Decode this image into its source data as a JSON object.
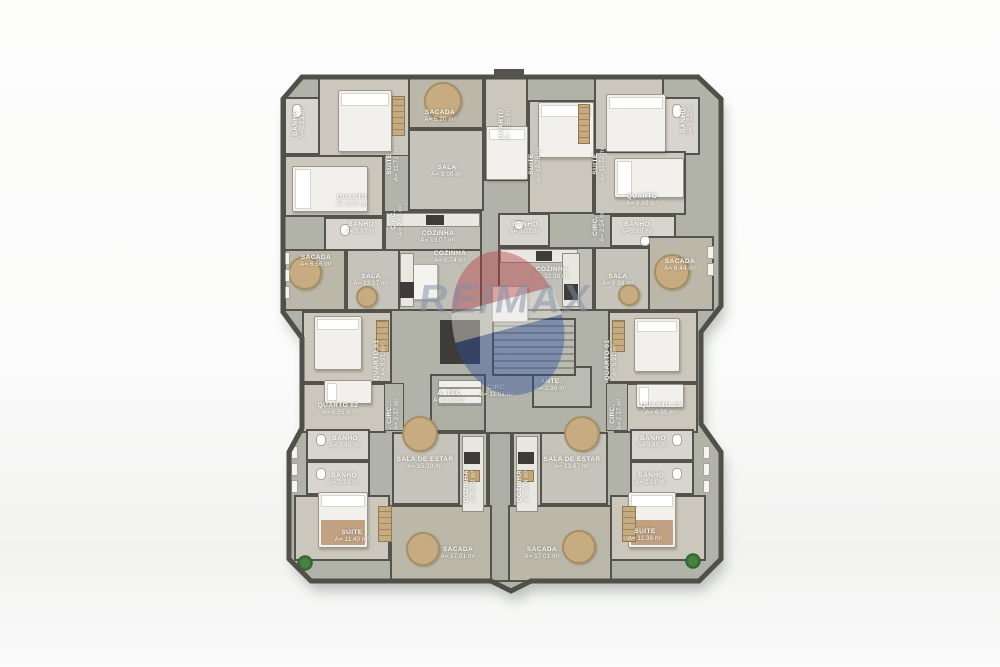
{
  "watermark": {
    "brand": "RE/MAX"
  },
  "rooms": [
    {
      "name": "BANHO",
      "area": "A= 3.23 m²"
    },
    {
      "name": "SUITE",
      "area": "A= 11.72 m²"
    },
    {
      "name": "QUARTO",
      "area": "A= 9.90 m²"
    },
    {
      "name": "BANHO",
      "area": "A= 2.87 m²"
    },
    {
      "name": "SACADA",
      "area": "A= 5.20 m²"
    },
    {
      "name": "SALA",
      "area": "A= 8.00 m²"
    },
    {
      "name": "CIRC.",
      "area": "A= 2.54 m²"
    },
    {
      "name": "COZINHA",
      "area": "A= 13.07 m²"
    },
    {
      "name": "SACADA",
      "area": "A= 6.56 m²"
    },
    {
      "name": "SALA",
      "area": "A= 13.17 m²"
    },
    {
      "name": "COZINHA",
      "area": "A= 8.74 m²"
    },
    {
      "name": "QUARTO",
      "area": "A= 9.59 m²"
    },
    {
      "name": "SUITE",
      "area": "A= 12.79 m²"
    },
    {
      "name": "SUITE",
      "area": "A= 11.72 m²"
    },
    {
      "name": "BANHO",
      "area": "A= 3.22 m²"
    },
    {
      "name": "QUARTO",
      "area": "A= 9.90 m²"
    },
    {
      "name": "BANHO",
      "area": "A= 2.88 m²"
    },
    {
      "name": "BANHO",
      "area": "A= 3.02 m²"
    },
    {
      "name": "CIRC.",
      "area": "A= 2.54 m²"
    },
    {
      "name": "COZINHA",
      "area": "A= 12.38 m²"
    },
    {
      "name": "SALA",
      "area": "A= 9.38 m²"
    },
    {
      "name": "SACADA",
      "area": "A= 6.44 m²"
    },
    {
      "name": "A. TÉC",
      "area": "A= 2.14 m²"
    },
    {
      "name": "CIRC.",
      "area": "A= 11.01 m²"
    },
    {
      "name": "ANTE.",
      "area": "A= 2.36 m²"
    },
    {
      "name": "QUARTO 01",
      "area": "A= 9.91 m²"
    },
    {
      "name": "QUARTO 02",
      "area": "A= 6.95 m²"
    },
    {
      "name": "BANHO",
      "area": "A= 3.45 m²"
    },
    {
      "name": "BANHO",
      "area": "A= 2.99 m²"
    },
    {
      "name": "CIRC.",
      "area": "A= 2.37 m²"
    },
    {
      "name": "SALA DE ESTAR",
      "area": "A= 15.39 m²"
    },
    {
      "name": "COZINHA",
      "area": "A= 5.72 m²"
    },
    {
      "name": "SUITE",
      "area": "A= 11.40 m²"
    },
    {
      "name": "SACADA",
      "area": "A= 17.01 m²"
    },
    {
      "name": "QUARTO 01",
      "area": "A= 9.91 m²"
    },
    {
      "name": "QUARTO 02",
      "area": "A= 6.95 m²"
    },
    {
      "name": "BANHO",
      "area": "A= 3.45 m²"
    },
    {
      "name": "BANHO",
      "area": "A= 2.91 m²"
    },
    {
      "name": "CIRC.",
      "area": "A= 2.37 m²"
    },
    {
      "name": "SALA DE ESTAR",
      "area": "A= 13.67 m²"
    },
    {
      "name": "COZINHA",
      "area": "A= 5.44 m²"
    },
    {
      "name": "SUITE",
      "area": "A= 11.38 m²"
    },
    {
      "name": "SACADA",
      "area": "A= 17.01 m²"
    }
  ]
}
